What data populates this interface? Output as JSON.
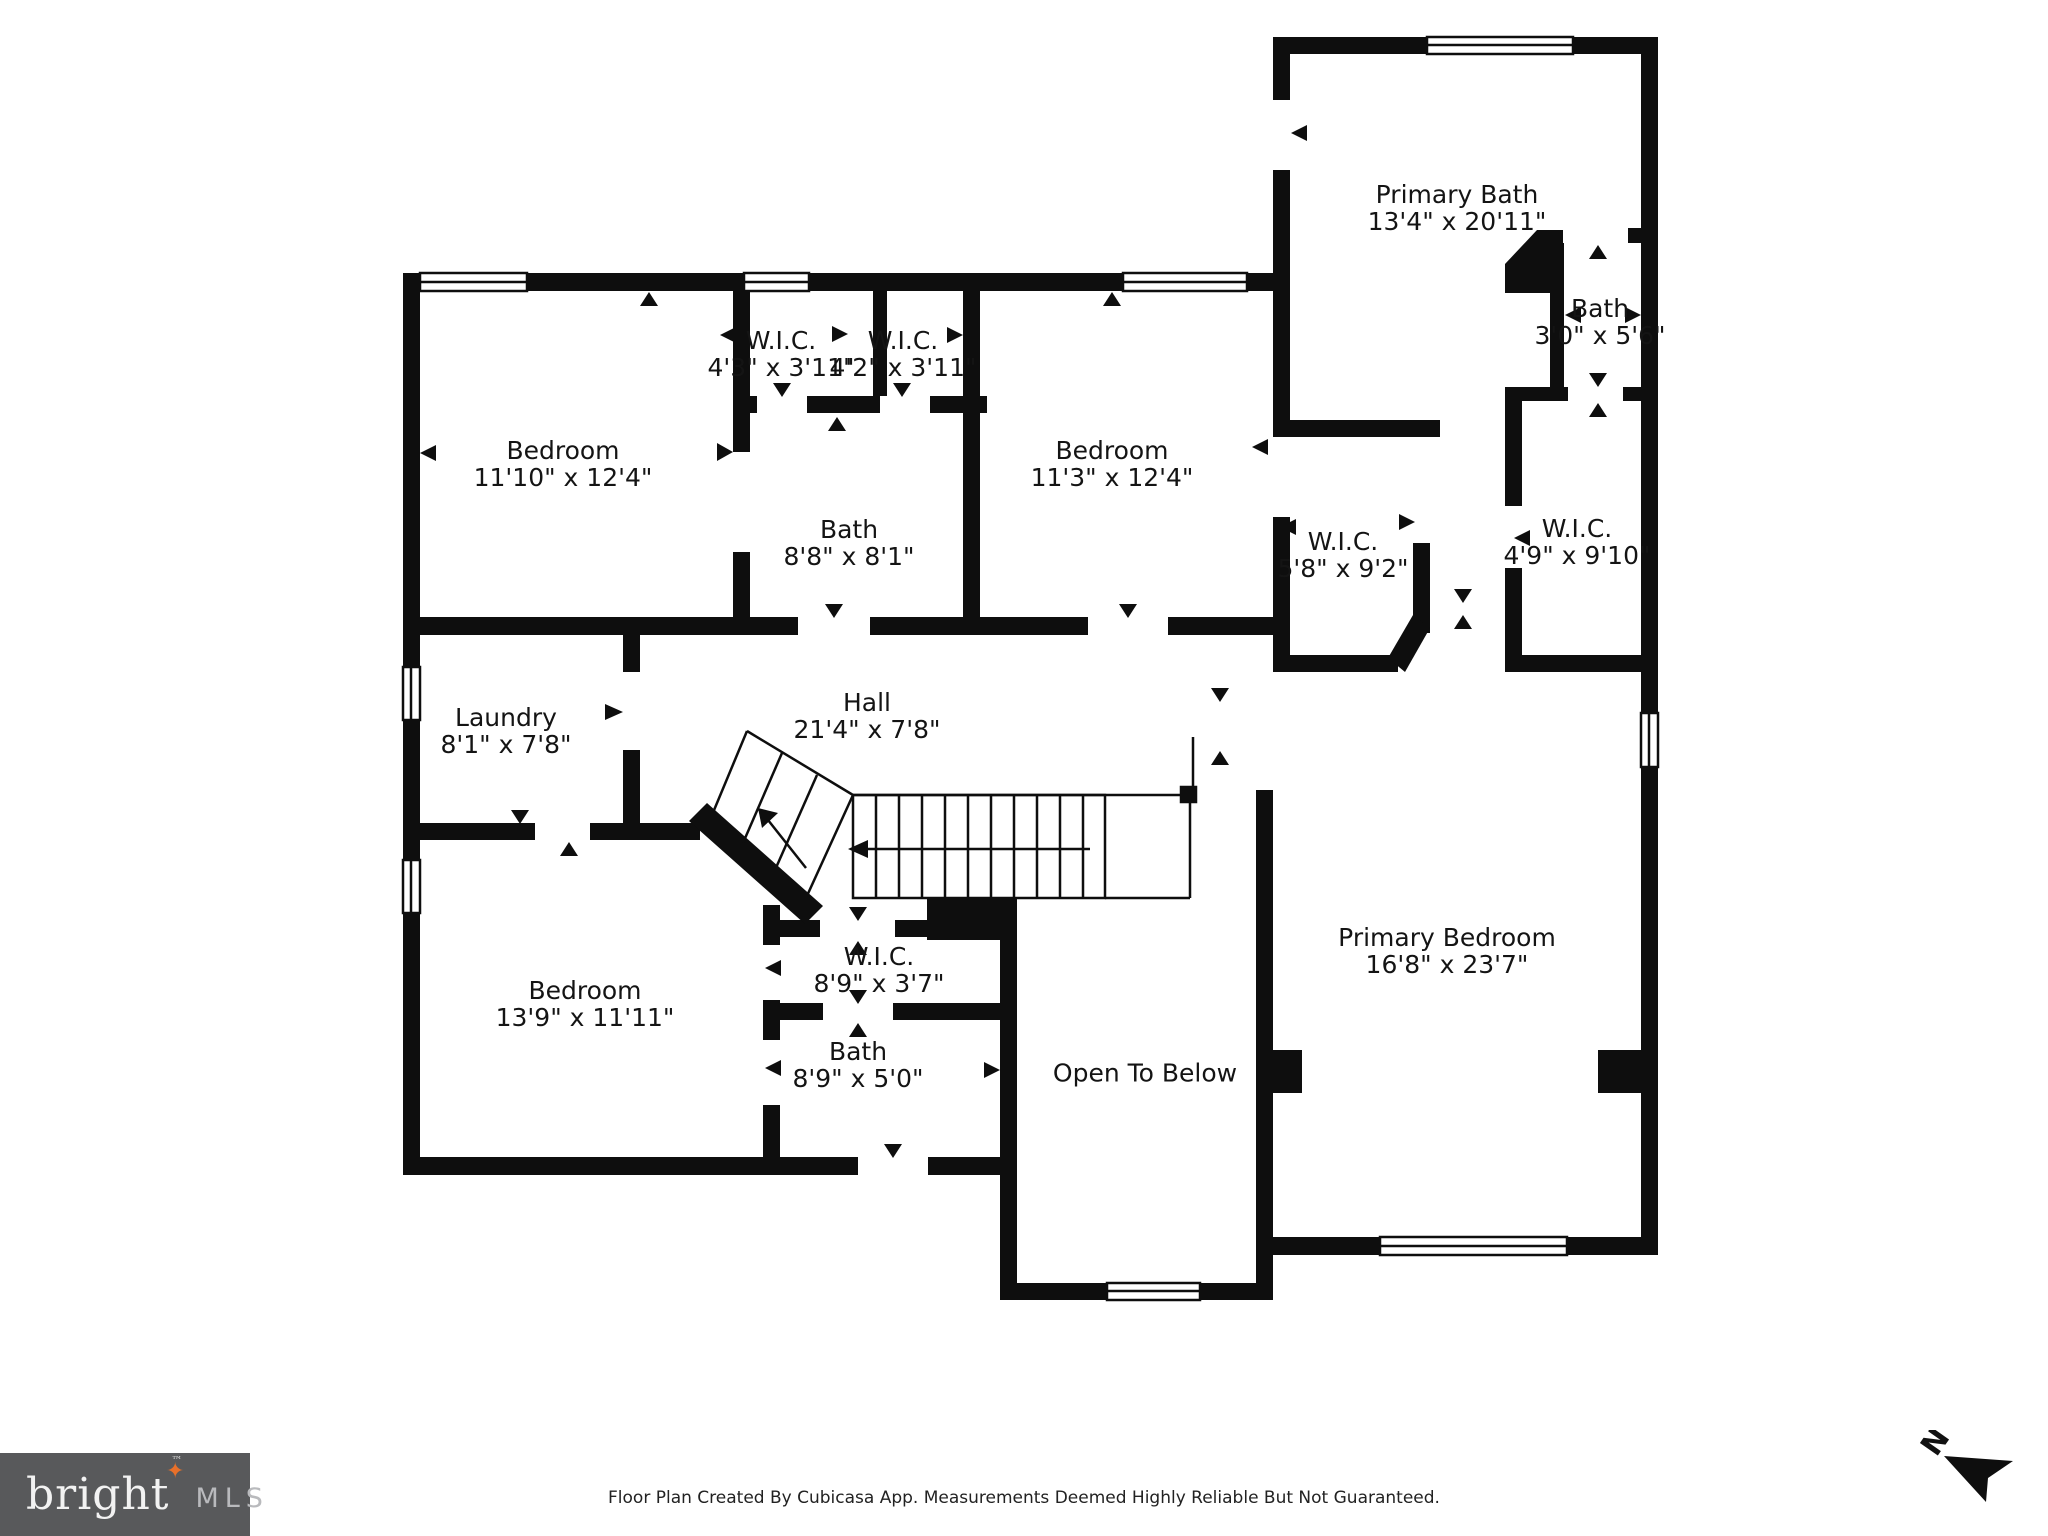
{
  "rooms": [
    {
      "name": "Primary Bath",
      "dims": "13'4\" x 20'11\"",
      "x": 1457,
      "y": 208
    },
    {
      "name": "Bath",
      "dims": "3'0\" x 5'6\"",
      "x": 1600,
      "y": 322
    },
    {
      "name": "W.I.C.",
      "dims": "4'3\" x 3'11\"",
      "x": 781,
      "y": 354
    },
    {
      "name": "W.I.C.",
      "dims": "4'2\" x 3'11\"",
      "x": 903,
      "y": 354
    },
    {
      "name": "Bedroom",
      "dims": "11'10\" x 12'4\"",
      "x": 563,
      "y": 464
    },
    {
      "name": "Bedroom",
      "dims": "11'3\" x 12'4\"",
      "x": 1112,
      "y": 464
    },
    {
      "name": "Bath",
      "dims": "8'8\" x 8'1\"",
      "x": 849,
      "y": 543
    },
    {
      "name": "W.I.C.",
      "dims": "5'8\" x 9'2\"",
      "x": 1343,
      "y": 555
    },
    {
      "name": "W.I.C.",
      "dims": "4'9\" x 9'10\"",
      "x": 1577,
      "y": 542
    },
    {
      "name": "Laundry",
      "dims": "8'1\" x 7'8\"",
      "x": 506,
      "y": 731
    },
    {
      "name": "Hall",
      "dims": "21'4\" x 7'8\"",
      "x": 867,
      "y": 716
    },
    {
      "name": "Bedroom",
      "dims": "13'9\" x 11'11\"",
      "x": 585,
      "y": 1004
    },
    {
      "name": "W.I.C.",
      "dims": "8'9\" x 3'7\"",
      "x": 879,
      "y": 970
    },
    {
      "name": "Bath",
      "dims": "8'9\" x 5'0\"",
      "x": 858,
      "y": 1065
    },
    {
      "name": "Open To Below",
      "dims": "",
      "x": 1145,
      "y": 1073
    },
    {
      "name": "Primary Bedroom",
      "dims": "16'8\" x 23'7\"",
      "x": 1447,
      "y": 951
    }
  ],
  "footer": {
    "text": "Floor Plan Created By Cubicasa App. Measurements Deemed Highly Reliable But Not Guaranteed."
  },
  "logo": {
    "brand": "bright",
    "tm": "™",
    "suffix": "MLS",
    "star": "✦",
    "star_color": "#e8702a",
    "background": "#58595b"
  },
  "compass": {
    "label": "N"
  },
  "colors": {
    "wall": "#0e0e0e",
    "background": "#ffffff",
    "label_text": "#141414",
    "footer_text": "#222222"
  }
}
